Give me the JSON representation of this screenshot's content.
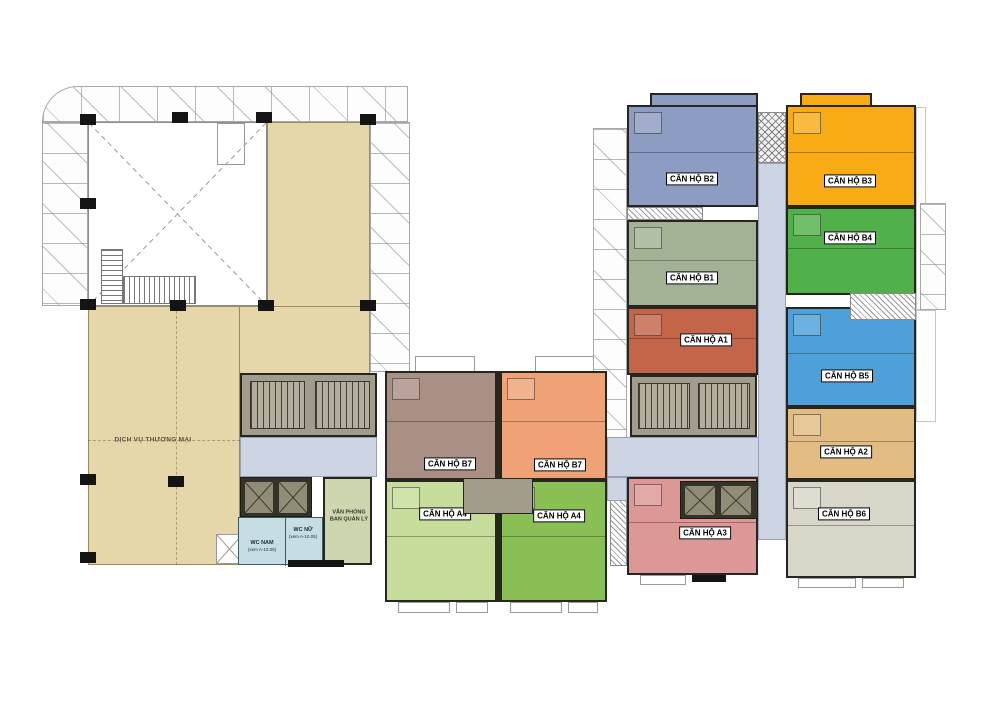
{
  "plan": {
    "commercial": {
      "label": "DỊCH VỤ THƯƠNG MẠI",
      "color": "#e6d7ab"
    },
    "office": {
      "line1": "VĂN PHÒNG",
      "line2": "BAN QUẢN LÝ",
      "color": "#ced6af"
    },
    "wc_nam": {
      "label": "WC NAM",
      "note": "(xem A-10.05)"
    },
    "wc_nu": {
      "label": "WC NỮ",
      "note": "(xem A-10.05)"
    },
    "wc_color": "#c4dee3",
    "corridor_color": "#cdd4e3",
    "core_color": "#a29c8d"
  },
  "units": [
    {
      "id": "b2",
      "label": "CĂN HỘ B2",
      "color": "#8c9cc3"
    },
    {
      "id": "b3",
      "label": "CĂN HỘ B3",
      "color": "#f8ab15"
    },
    {
      "id": "b1",
      "label": "CĂN HỘ B1",
      "color": "#a3b295"
    },
    {
      "id": "b4",
      "label": "CĂN HỘ B4",
      "color": "#50b14b"
    },
    {
      "id": "a1",
      "label": "CĂN HỘ A1",
      "color": "#c4654a"
    },
    {
      "id": "b5",
      "label": "CĂN HỘ B5",
      "color": "#4da0d9"
    },
    {
      "id": "b7-left",
      "label": "CĂN HỘ B7",
      "color": "#aa8f85"
    },
    {
      "id": "b7-right",
      "label": "CĂN HỘ B7",
      "color": "#eea276"
    },
    {
      "id": "a2",
      "label": "CĂN HỘ A2",
      "color": "#e2bc82"
    },
    {
      "id": "a4-left",
      "label": "CĂN HỘ A4",
      "color": "#c7dd9c"
    },
    {
      "id": "a4-right",
      "label": "CĂN HỘ A4",
      "color": "#89bf54"
    },
    {
      "id": "a3",
      "label": "CĂN HỘ A3",
      "color": "#dd9797"
    },
    {
      "id": "b6",
      "label": "CĂN HỘ B6",
      "color": "#d8d6c9"
    }
  ]
}
